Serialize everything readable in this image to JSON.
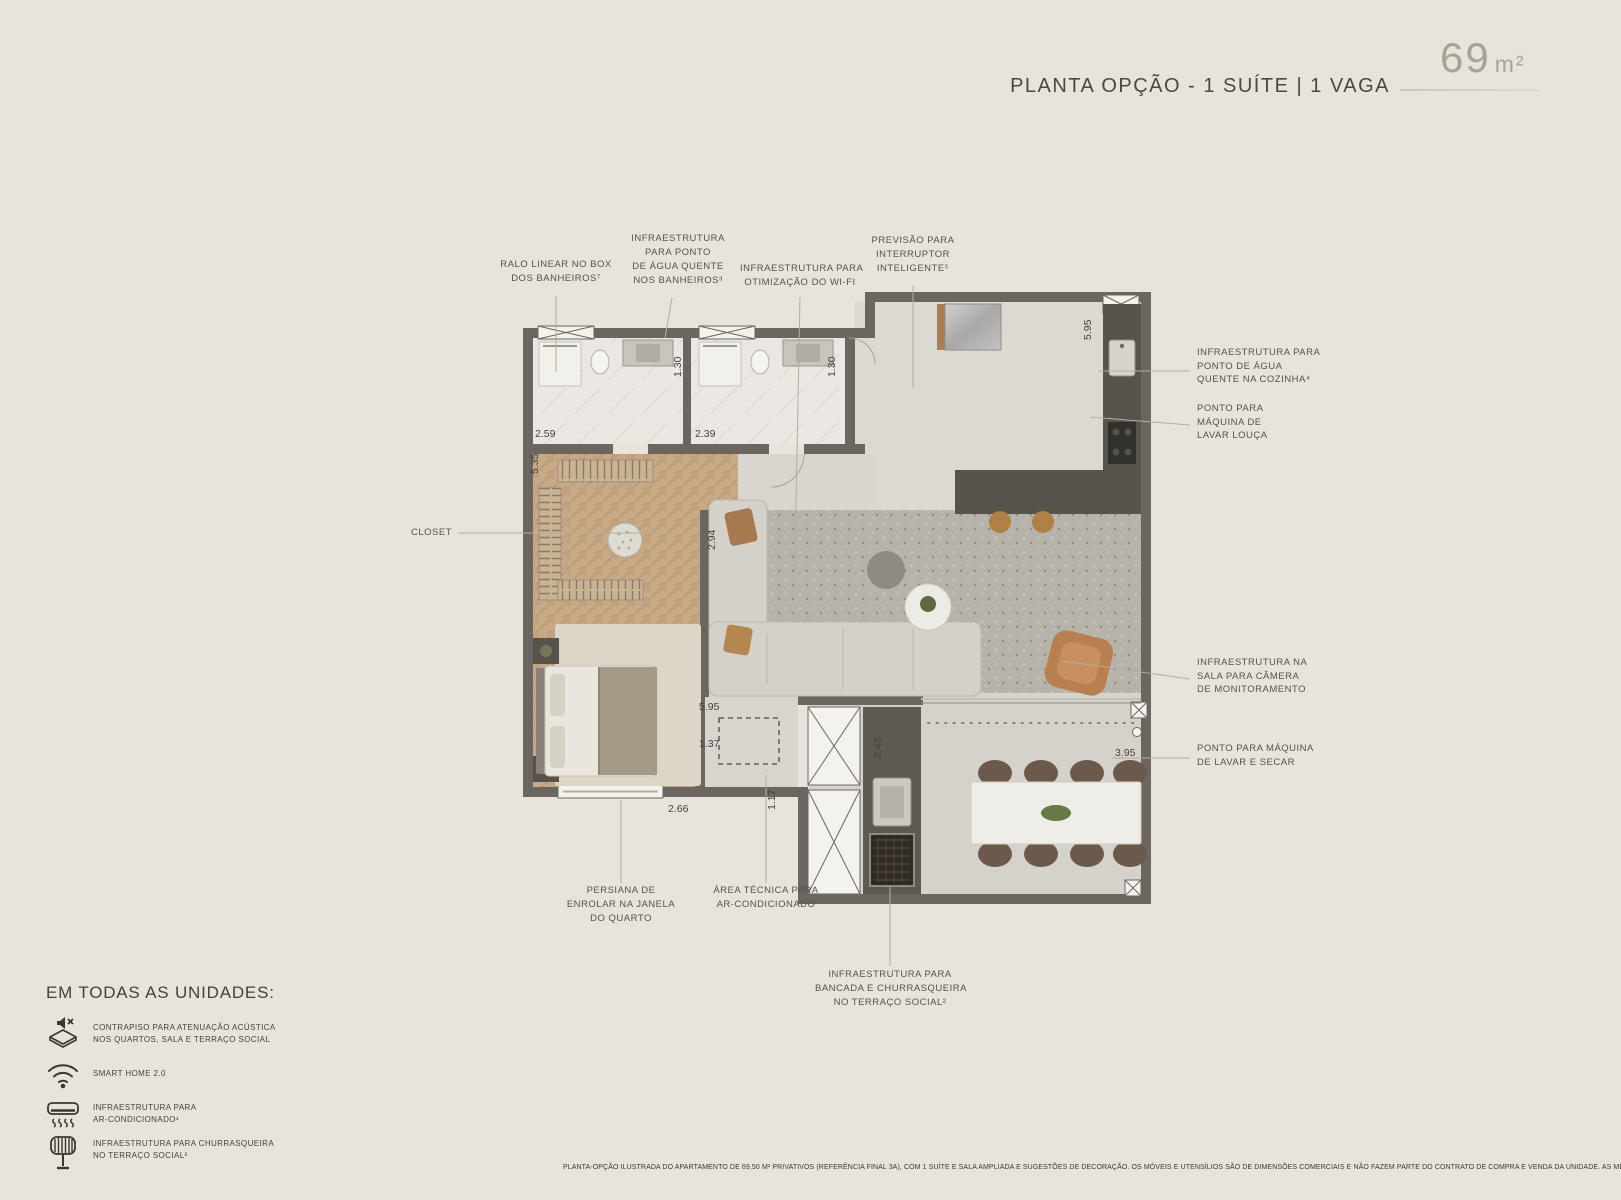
{
  "header": {
    "title": "PLANTA OPÇÃO - 1 SUÍTE | 1 VAGA",
    "area_value": "69",
    "area_unit": "m²"
  },
  "callouts": {
    "ralo_linear": {
      "lines": [
        "RALO LINEAR NO BOX",
        "DOS BANHEIROS⁷"
      ]
    },
    "agua_quente_banheiros": {
      "lines": [
        "INFRAESTRUTURA",
        "PARA PONTO",
        "DE ÁGUA QUENTE",
        "NOS BANHEIROS³"
      ]
    },
    "wifi": {
      "lines": [
        "INFRAESTRUTURA PARA",
        "OTIMIZAÇÃO DO WI-FI"
      ]
    },
    "interruptor_inteligente": {
      "lines": [
        "PREVISÃO PARA",
        "INTERRUPTOR",
        "INTELIGENTE⁵"
      ]
    },
    "agua_quente_cozinha": {
      "lines": [
        "INFRAESTRUTURA PARA",
        "PONTO DE ÁGUA",
        "QUENTE NA COZINHA⁴"
      ]
    },
    "lavar_louca": {
      "lines": [
        "PONTO PARA",
        "MÁQUINA DE",
        "LAVAR LOUÇA"
      ]
    },
    "camera_monitoramento": {
      "lines": [
        "INFRAESTRUTURA NA",
        "SALA PARA CÂMERA",
        "DE MONITORAMENTO"
      ]
    },
    "lavar_secar": {
      "lines": [
        "PONTO PARA MÁQUINA",
        "DE LAVAR E SECAR"
      ]
    },
    "closet": {
      "lines": [
        "CLOSET"
      ]
    },
    "persiana": {
      "lines": [
        "PERSIANA DE",
        "ENROLAR NA JANELA",
        "DO QUARTO"
      ]
    },
    "area_tecnica": {
      "lines": [
        "ÁREA TÉCNICA PARA",
        "AR-CONDICIONADO"
      ]
    },
    "churrasqueira_terraco": {
      "lines": [
        "INFRAESTRUTURA PARA",
        "BANCADA E CHURRASQUEIRA",
        "NO TERRAÇO SOCIAL²"
      ]
    }
  },
  "plan": {
    "dimensions": {
      "bath1_width": "2.59",
      "bath1_depth": "1.30",
      "bath2_width": "2.39",
      "bath2_depth": "1.30",
      "closet_depth": "5.35",
      "kitchen_side": "5.95",
      "living_inner_wall": "2.94",
      "living_width": "5.95",
      "tech_area_width": "1.37",
      "tech_area_height": "1.17",
      "terrace_counter_depth": "2.43",
      "bedroom_width": "2.66",
      "terrace_width": "3.95"
    }
  },
  "legend": {
    "heading": "EM TODAS AS UNIDADES:",
    "items": [
      {
        "icon": "acoustic-floor-icon",
        "lines": [
          "CONTRAPISO PARA ATENUAÇÃO ACÚSTICA",
          "NOS QUARTOS, SALA E TERRAÇO SOCIAL"
        ]
      },
      {
        "icon": "wifi-icon",
        "lines": [
          "SMART HOME 2.0"
        ]
      },
      {
        "icon": "air-conditioner-icon",
        "lines": [
          "INFRAESTRUTURA PARA",
          "AR-CONDICIONADO¹"
        ]
      },
      {
        "icon": "barbecue-icon",
        "lines": [
          "INFRAESTRUTURA PARA CHURRASQUEIRA",
          "NO TERRAÇO SOCIAL²"
        ]
      }
    ]
  },
  "disclaimer": "PLANTA-OPÇÃO ILUSTRADA DO APARTAMENTO DE 69,50 M² PRIVATIVOS (REFERÊNCIA FINAL 3A), COM 1 SUÍTE E SALA AMPLIADA E SUGESTÕES DE DECORAÇÃO. OS MÓVEIS E UTENSÍLIOS SÃO DE DIMENSÕES COMERCIAIS E NÃO FAZEM PARTE DO CONTRATO DE COMPRA E VENDA DA UNIDADE. AS MEDIDAS SÃO INTERNAS E DE FACE A FACE DAS PAREDES.",
  "colors": {
    "background": "#e8e4db",
    "wall": "#6b6760",
    "wood_floor": "#c8a985",
    "leader_line": "#b8ae97",
    "area_text": "#a5a499",
    "body_text": "#55524b"
  }
}
